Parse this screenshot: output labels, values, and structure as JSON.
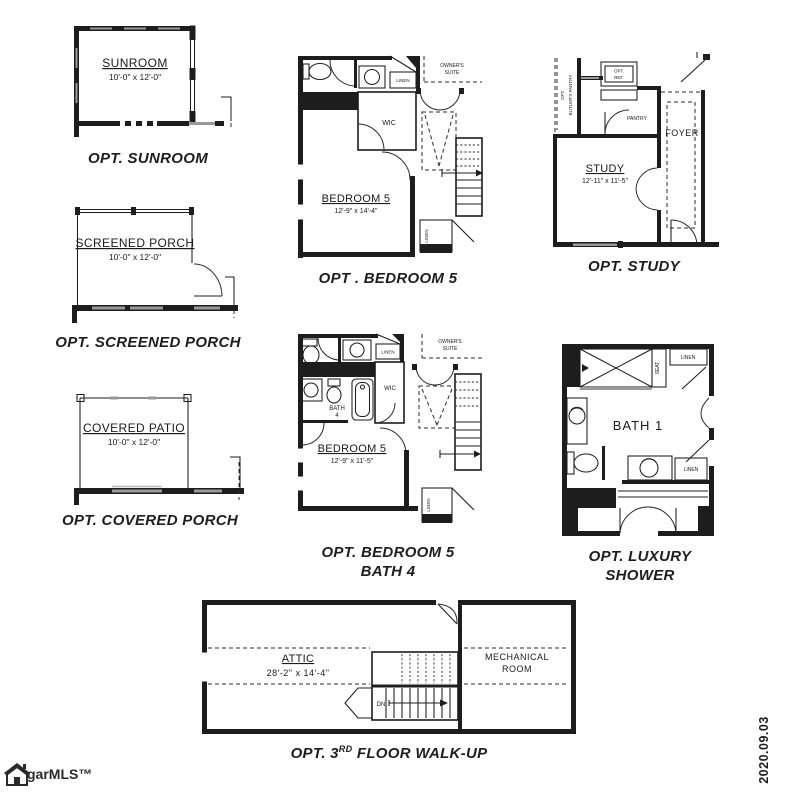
{
  "sheet": {
    "background": "#ffffff",
    "ink": "#1d1d1d",
    "window_gray": "#9a9a9a",
    "date_stamp": "2020.09.03",
    "logo": {
      "text": "garMLS™",
      "icon": "house-icon"
    }
  },
  "plans": {
    "sunroom": {
      "caption": "OPT. SUNROOM",
      "label": "SUNROOM",
      "dims": "10'-0\" x 12'-0\""
    },
    "screened_porch": {
      "caption": "OPT. SCREENED PORCH",
      "label": "SCREENED PORCH",
      "dims": "10'-0\" x 12'-0\""
    },
    "covered_porch": {
      "caption": "OPT. COVERED PORCH",
      "label": "COVERED PATIO",
      "dims": "10'-0\" x 12'-0\""
    },
    "bedroom5": {
      "caption": "OPT . BEDROOM 5",
      "label": "BEDROOM 5",
      "dims": "12'-9\" x 14'-4\"",
      "wic": "WIC",
      "linen_top": "LINEN",
      "linen_bottom": "LINEN",
      "owners_suite_line1": "OWNER'S",
      "owners_suite_line2": "SUITE"
    },
    "study": {
      "caption": "OPT. STUDY",
      "label": "STUDY",
      "dims": "12'-11\" x 11'-5\"",
      "pantry": "PANTRY",
      "foyer": "FOYER",
      "ref_line1": "OPT.",
      "ref_line2": "REF.",
      "butlers_line1": "OPT.",
      "butlers_line2": "BUTLER'S PANTRY"
    },
    "bedroom5_bath4": {
      "caption_line1": "OPT. BEDROOM 5",
      "caption_line2": "BATH 4",
      "label": "BEDROOM 5",
      "dims": "12'-9\" x 11'-5\"",
      "bath_line1": "BATH",
      "bath_line2": "4",
      "wic": "WIC",
      "linen_top": "LINEN",
      "linen_bottom": "LINEN",
      "owners_suite_line1": "OWNER'S",
      "owners_suite_line2": "SUITE"
    },
    "luxury_shower": {
      "caption_line1": "OPT. LUXURY",
      "caption_line2": "SHOWER",
      "label": "BATH 1",
      "seat": "SEAT",
      "linen_top": "LINEN",
      "linen_bottom": "LINEN"
    },
    "walkup": {
      "caption_prefix": "OPT. 3",
      "caption_sup": "RD",
      "caption_suffix": " FLOOR WALK-UP",
      "attic_label": "ATTIC",
      "attic_dims": "28'-2\" x 14'-4\"",
      "mech_line1": "MECHANICAL",
      "mech_line2": "ROOM",
      "down_label": "DN"
    }
  }
}
